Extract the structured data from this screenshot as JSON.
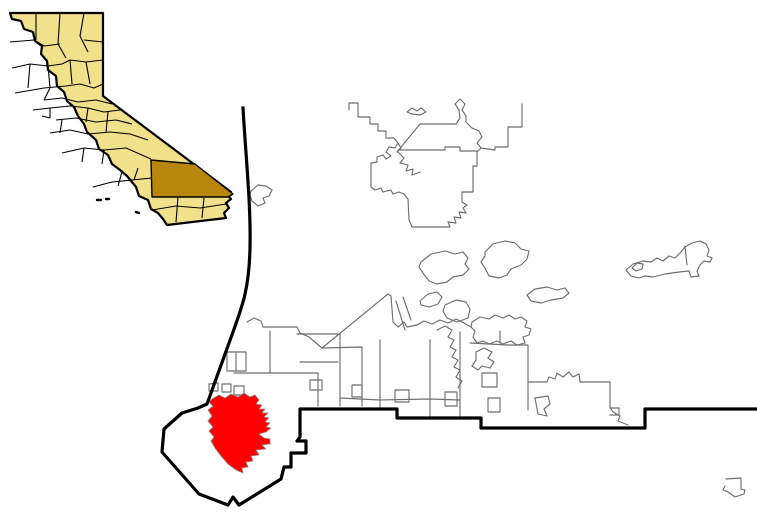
{
  "map": {
    "kind": "city-locator-map",
    "colors": {
      "background": "#ffffff",
      "county_fill": "#F2E18B",
      "highlight_county_fill": "#B8860B",
      "highlight_city_fill": "#FF0000",
      "highlight_city_stroke": "#8a8a8a",
      "black_border": "#000000",
      "city_boundary_gray": "#6E6E6E"
    },
    "inset": {
      "state_outline": "M10,13 L103,13 L103,96 L231,192 L228,196 L231,199 L226,203 L229,208 L224,213 L226,218 L167,225 L163,219 L158,213 L151,209 L148,200 L139,196 L136,187 L127,176 L120,170 L112,164 L108,155 L99,149 L96,140 L87,132 L84,124 L78,116 L74,107 L67,101 L64,92 L57,86 L56,76 L48,70 L47,61 L41,54 L42,46 L35,41 L33,32 L24,29 L21,21 L12,19 Z",
      "county_mesh": "M10,42 L34,40 L44,46 L60,44 M36,13 L36,40 M60,13 L58,44 M58,44 L66,58 M84,13 L80,36 L88,52 M103,42 L84,40 M12,68 L30,64 L48,66 L62,64 M103,60 L86,62 L70,60 L62,64 M30,64 L28,88 M48,66 L50,88 L44,100 M15,93 L44,88 L66,86 L80,84 L94,88 L103,84 M70,60 L72,84 M86,62 L90,84 M44,100 L62,98 L78,102 L96,100 L112,104 M33,110 L50,108 L50,118 L42,116 M50,108 L70,106 L88,108 L104,112 L120,110 M56,120 L76,118 L96,122 L116,120 L132,124 M50,133 L70,130 L88,134 L110,132 L130,134 L148,140 M62,120 L60,133 M88,108 L86,122 M108,112 L106,132 M62,153 L84,148 L104,150 L126,148 L151,159 M84,148 L82,162 M104,150 L102,164 M93,187 L112,182 L132,180 L152,178 M118,186 L122,172 M134,180 L138,168 M152,210 L176,206 L200,208 L226,204 M178,197 L176,222 M204,198 L202,218",
      "islands": "M97,200 L101,200 M106,199 L109,199 M136,212 L139,213",
      "highlighted_county": "M151,160 L195,164 L233,194 L228,197 L152,197 Z"
    },
    "main": {
      "county_boundary": "M243,108 C246,160 251,205 250,248 C249,292 241,309 233,332 L207,404 L198,408 L182,413 L164,429 L162,452 L199,494 L228,505 L233,497 L239,505 L281,479 L284,467 L291,467 L291,453 L306,453 L306,441 L297,441 L300,437 L300,409 L397,409 L397,418 L481,418 L481,428 L645,428 L645,409 L757,409",
      "highlighted_city": "M212,399 L219,395 L225,398 L231,394 L238,397 L244,393 L250,397 L255,395 L259,400 L256,404 L262,405 L259,409 L265,409 L262,413 L268,413 L264,417 L269,418 L265,422 L270,423 L266,427 L271,428 L266,432 L259,434 L264,438 L270,439 L270,444 L262,445 L266,449 L256,450 L259,455 L251,456 L253,461 L246,462 L248,467 L242,468 L243,473 L236,470 L228,464 L221,456 L215,448 L211,441 L214,437 L209,431 L213,427 L208,421 L212,416 L208,410 L213,406 L209,402 Z",
      "city_boundaries": [
        "M251,191 L258,185 L266,186 L272,190 L269,196 L263,198 L265,203 L258,206 L252,201 L250,195 Z",
        "M407,112 L412,108 L417,111 L421,108 L426,112 L420,115 L412,114 Z",
        "M349,110 L349,103 L358,103 L358,117 L370,117 L370,124 L378,124 L378,131 L386,131 L386,138 L394,138 L398,143 L401,148 L397,152 L420,124 L456,124 L460,118 L459,110 L455,104 L460,99 L465,104 L462,110 L466,116 L466,122 L472,128 L479,131 L482,137 L477,143 L481,148 L477,152 L477,166 L473,166 L473,192 L462,192 L462,202 L467,205 L463,208 L466,213 L459,212 L461,218 L454,217 L456,223 L448,222 L450,227 L412,227 L409,220 L408,199 L404,194 L399,192 L393,194 L391,190 L383,192 L381,188 L375,190 L371,187 L371,163 L377,162 L377,157 L383,155 L386,159 L391,156 L386,152 L389,147 L395,148 L398,143",
        "M522,104 L522,127 L508,127 L508,147 L495,147 L495,150 L481,148",
        "M398,152 L404,158 L400,163 L408,165 L406,171 L413,169 L412,175 L420,172",
        "M398,150 L445,150 L445,147 L460,147 L460,151 L477,151",
        "M421,262 L431,254 L445,251 L455,254 L463,252 L468,258 L465,264 L469,269 L463,275 L453,277 L447,282 L437,284 L429,281 L423,273 L419,267 Z",
        "M485,252 L493,244 L505,241 L515,243 L521,249 L529,251 L527,259 L521,265 L511,269 L507,275 L499,278 L489,276 L485,268 L481,262 L485,256 Z",
        "M527,295 L535,289 L547,287 L557,290 L565,288 L569,293 L563,298 L551,300 L541,303 L531,301 Z",
        "M626,270 L633,264 L643,261 L651,262 L657,258 L663,261 L669,256 L675,258 L681,252 L685,247 L692,243 L700,241 L706,244 L709,250 L707,256 L712,258 L710,262 L704,261 L700,265 L697,271 L699,276 L691,277 L689,271 L679,272 L665,274 L653,277 L645,276 L639,278 L631,276 Z",
        "M632,268 L637,263 L643,264 L642,269 L636,271 Z",
        "M685,246 L687,265",
        "M726,479 L741,478 L741,489 L745,490 L744,494 L735,497 L728,492 L723,490 L725,486",
        "M247,322 L254,318 L261,321 L263,327 L297,327 L300,333 L309,337 L322,348 L388,294 L391,296 L393,322 L398,327 L404,322 L407,327 L417,325",
        "M396,301 L405,330 M403,297 L411,320",
        "M420,301 L428,294 L437,292 L442,297 L438,304 L429,307 L421,305 Z",
        "M445,305 L456,300 L466,302 L470,309 L468,318 L457,322 L447,318 L443,311 Z",
        "M472,322 L480,317 L489,319 L495,315 L503,318 L509,315 L515,319 L521,317 L527,321 L525,327 L531,329 L529,335 L523,337 L525,343 L517,345 L511,341 L503,344 L497,341 L489,344 L483,341 L477,343 L473,337 L475,331 L471,327 Z",
        "M417,325 L424,321 L432,324 L440,320 L448,323 L456,319 L464,323 L471,327",
        "M234,373 L270,373 M270,331 L270,373 M270,373 L318,373 M318,373 L318,406 M297,334 L340,334 M340,334 L340,406 M300,362 L338,362 M322,348 L362,347 M362,347 L362,406",
        "M380,340 L380,408 M430,340 L430,417 M460,332 L460,417 M340,398 L380,400 M380,400 L430,399 M430,399 L460,400",
        "M437,330 L445,326 L452,330 L448,337 L454,340 L450,347 L456,350 L452,357 L458,360 L454,367 L460,370 L456,377 L462,381 L458,388",
        "M470,343 L508,345 M500,331 L500,343 M508,345 L528,345 M528,345 L528,410 M528,382 L547,382 M547,382 L549,377 L555,379 L557,373 L563,377 L569,372 L573,377 L579,374 L580,382 M580,382 L610,382 M610,382 L610,407 M610,407 L613,412 L620,416 L618,421 L628,425 M610,408 L619,408 L619,415 L610,415",
        "M482,373 L497,373 L497,387 L482,387 Z",
        "M476,352 L484,348 L492,352 L488,358 L494,362 L490,368 L482,366 L478,370 L472,366 L476,360 Z",
        "M310,380 L322,380 L322,390 L310,390 Z M352,385 L362,385 L362,397 L352,397 Z M395,390 L409,390 L409,402 L395,402 Z M445,392 L457,392 L457,406 L445,406 Z M488,398 L500,398 L500,412 L488,412 Z M535,398 L548,396 L550,404 L544,409 L547,416 L538,414 Z",
        "M227,352 L246,352 L246,371 L227,371 Z M236,352 L236,371",
        "M209,384 L218,383 L218,391 L209,391 Z M222,384 L231,384 L231,392 L222,392 Z M234,386 L244,386 L244,395 L234,395 Z"
      ]
    }
  }
}
